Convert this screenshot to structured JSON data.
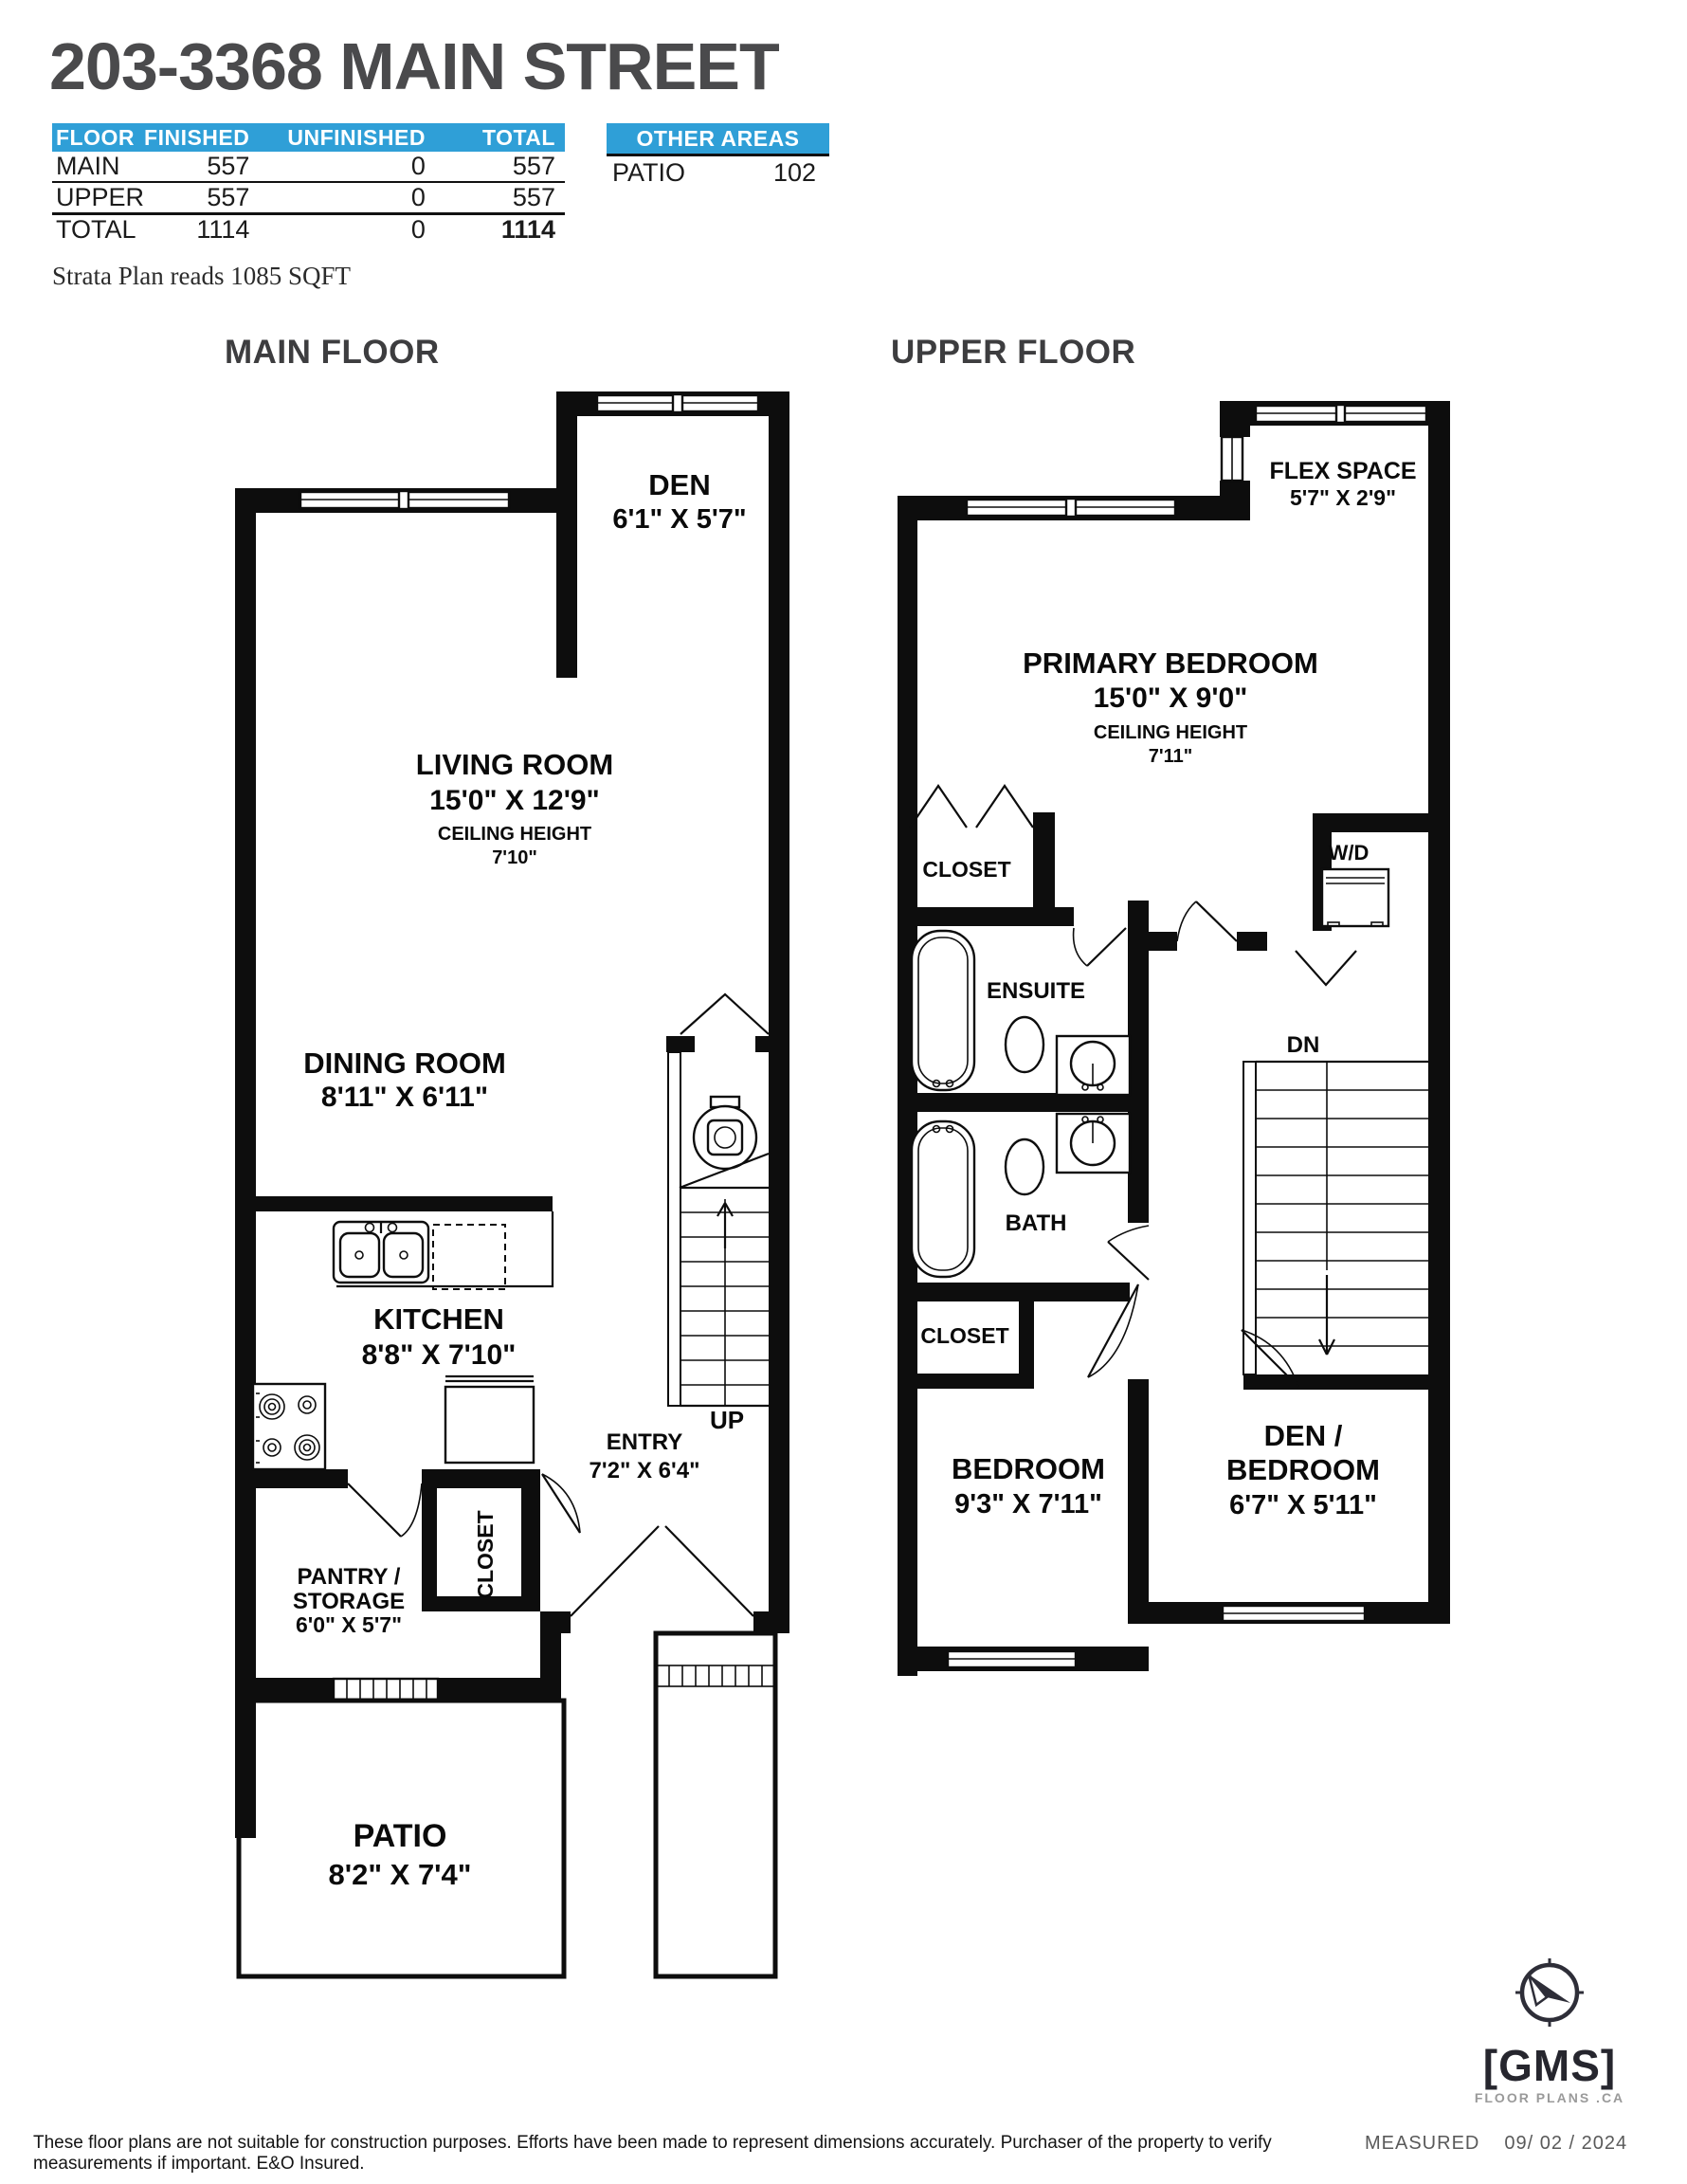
{
  "header": {
    "title": "203-3368 MAIN STREET",
    "area_table": {
      "columns": [
        "FLOOR",
        "FINISHED",
        "UNFINISHED",
        "TOTAL"
      ],
      "rows": [
        {
          "floor": "MAIN",
          "finished": "557",
          "unfinished": "0",
          "total": "557"
        },
        {
          "floor": "UPPER",
          "finished": "557",
          "unfinished": "0",
          "total": "557"
        },
        {
          "floor": "TOTAL",
          "finished": "1114",
          "unfinished": "0",
          "total": "1114"
        }
      ]
    },
    "other_areas": {
      "title": "OTHER AREAS",
      "rows": [
        {
          "name": "PATIO",
          "value": "102"
        }
      ]
    },
    "strata_note": "Strata Plan reads 1085 SQFT"
  },
  "floors": {
    "main": {
      "label": "MAIN FLOOR",
      "rooms": {
        "den": {
          "name": "DEN",
          "dims": "6'1\" X 5'7\""
        },
        "living": {
          "name": "LIVING ROOM",
          "dims": "15'0\" X 12'9\"",
          "ceiling_label": "CEILING HEIGHT",
          "ceiling_value": "7'10\""
        },
        "dining": {
          "name": "DINING ROOM",
          "dims": "8'11\" X 6'11\""
        },
        "kitchen": {
          "name": "KITCHEN",
          "dims": "8'8\" X 7'10\""
        },
        "closet": {
          "name": "CLOSET"
        },
        "entry": {
          "name": "ENTRY",
          "dims": "7'2\" X 6'4\""
        },
        "pantry": {
          "name_line1": "PANTRY /",
          "name_line2": "STORAGE",
          "dims": "6'0\" X 5'7\""
        },
        "patio": {
          "name": "PATIO",
          "dims": "8'2\" X 7'4\""
        },
        "stairs": {
          "label": "UP"
        }
      }
    },
    "upper": {
      "label": "UPPER FLOOR",
      "rooms": {
        "flex": {
          "name": "FLEX SPACE",
          "dims": "5'7\" X 2'9\""
        },
        "primary": {
          "name": "PRIMARY BEDROOM",
          "dims": "15'0\" X 9'0\"",
          "ceiling_label": "CEILING HEIGHT",
          "ceiling_value": "7'11\""
        },
        "closet_primary": {
          "name": "CLOSET"
        },
        "laundry": {
          "name": "W/D"
        },
        "ensuite": {
          "name": "ENSUITE"
        },
        "bath": {
          "name": "BATH"
        },
        "closet_bedroom": {
          "name": "CLOSET"
        },
        "bedroom": {
          "name": "BEDROOM",
          "dims": "9'3\" X 7'11\""
        },
        "den_bedroom": {
          "name_line1": "DEN /",
          "name_line2": "BEDROOM",
          "dims": "6'7\" X 5'11\""
        },
        "stairs": {
          "label": "DN"
        }
      }
    }
  },
  "footer": {
    "disclaimer": "These floor plans are not suitable for construction purposes. Efforts have been made to represent dimensions accurately.   Purchaser of the property to verify measurements if important.  E&O Insured.",
    "logo": {
      "name": "[GMS]",
      "tagline": "FLOOR PLANS .CA"
    },
    "measured_label": "MEASURED",
    "measured_date": "09/ 02 / 2024"
  },
  "colors": {
    "accent_blue": "#2F9FD7",
    "wall": "#0D0D0D",
    "title_gray": "#4A4A4C"
  }
}
